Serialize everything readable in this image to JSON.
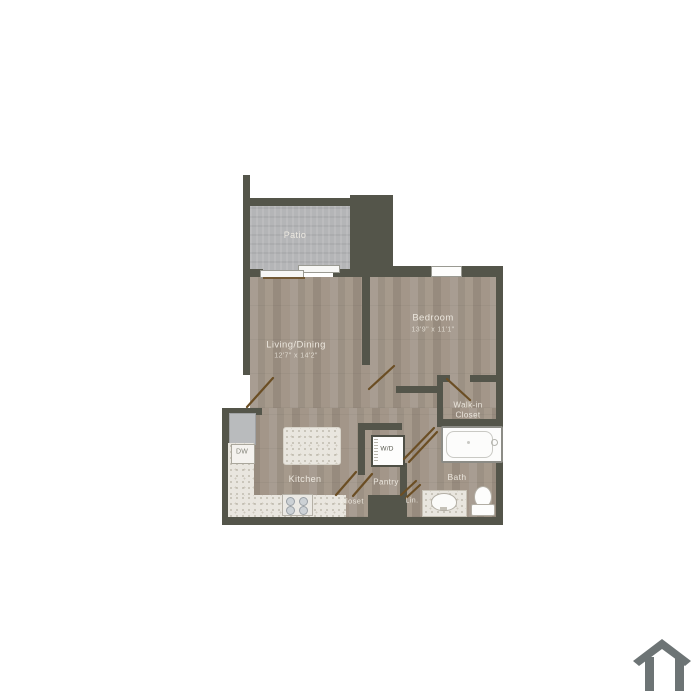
{
  "plan": {
    "rooms": {
      "patio": {
        "label": "Patio"
      },
      "living": {
        "label": "Living/Dining",
        "dims": "12'7\" x 14'2\""
      },
      "bedroom": {
        "label": "Bedroom",
        "dims": "13'9\" x 11'1\""
      },
      "walkin_closet": {
        "label_line1": "Walk-in",
        "label_line2": "Closet"
      },
      "bath": {
        "label": "Bath"
      },
      "kitchen": {
        "label": "Kitchen"
      },
      "pantry": {
        "label": "Pantry"
      },
      "closet": {
        "label": "Closet"
      },
      "linen": {
        "label": "Lin."
      }
    },
    "fixtures": {
      "washer_dryer": {
        "label": "W/D"
      },
      "dishwasher": {
        "label": "DW"
      }
    },
    "colors": {
      "wall": "#54554a",
      "wood_floor": "#a1958a",
      "patio_floor": "#b4b5b7",
      "counter": "#e9e6df",
      "door_swing_line": "#6b4e24",
      "label_text": "#f2eee5",
      "house_icon": "#6d7475",
      "background": "#ffffff"
    }
  }
}
